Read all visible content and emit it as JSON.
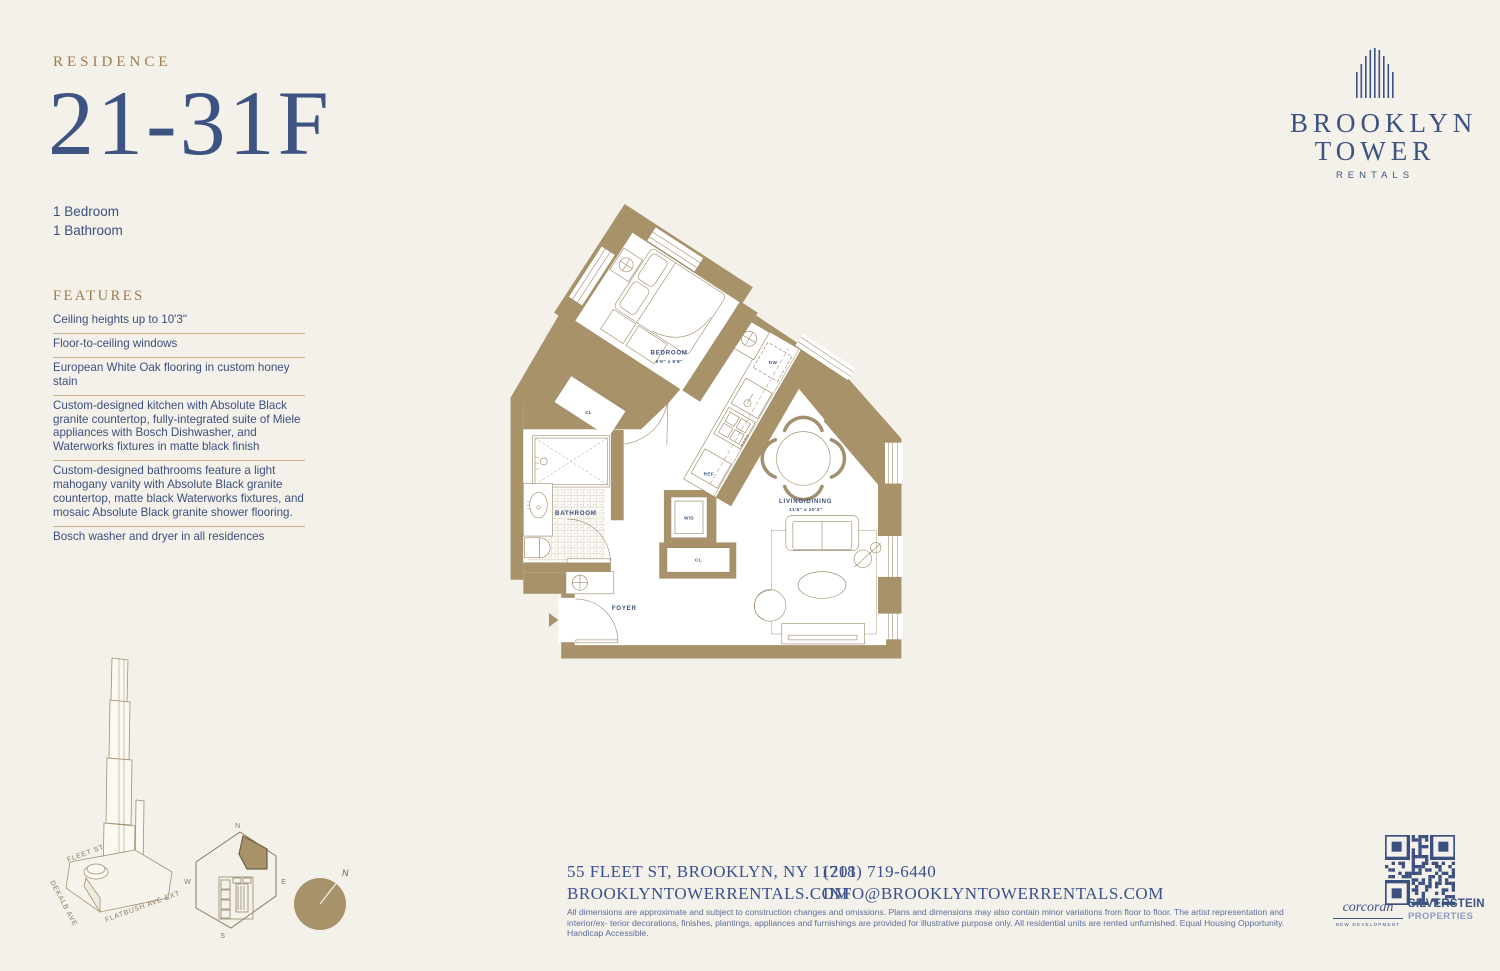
{
  "colors": {
    "accent_blue": "#3d5382",
    "gold": "#9b7b4e",
    "tan": "#a8926a",
    "bg": "#f4f1ea"
  },
  "header": {
    "residence_label": "RESIDENCE",
    "unit_number": "21-31F",
    "bedrooms": "1 Bedroom",
    "bathrooms": "1 Bathroom",
    "features_title": "FEATURES",
    "features": [
      "Ceiling heights up to 10'3\"",
      "Floor-to-ceiling windows",
      "European White Oak flooring in custom honey stain",
      "Custom-designed kitchen with Absolute Black granite countertop, fully-integrated suite of Miele appliances with Bosch Dishwasher, and Waterworks fixtures in matte black finish",
      "Custom-designed bathrooms feature a light mahogany vanity with Absolute Black granite countertop, matte black Waterworks fixtures, and mosaic Absolute Black granite shower flooring.",
      "Bosch washer and dryer in all residences"
    ]
  },
  "brand": {
    "line1": "BROOKLYN",
    "line2": "TOWER",
    "sub": "RENTALS"
  },
  "plan": {
    "bedroom_name": "BEDROOM",
    "bedroom_dims": "9'6\" x 9'8\"",
    "living_name": "LIVING/DINING",
    "living_dims": "11'6\" x 20'3\"",
    "bathroom_name": "BATHROOM",
    "foyer_name": "FOYER",
    "closet1": "CL",
    "closet2": "CL",
    "wd": "W/D",
    "ref": "REF",
    "dw": "DW"
  },
  "sitekey": {
    "n": "N",
    "e": "E",
    "s": "S",
    "w": "W"
  },
  "compass": {
    "n": "N"
  },
  "streets": {
    "fleet": "FLEET ST",
    "dekalb": "DEKALB AVE",
    "flatbush": "FLATBUSH AVE EXT"
  },
  "footer": {
    "address": "55 FLEET ST, BROOKLYN, NY 11201",
    "website": "BROOKLYNTOWERRENTALS.COM",
    "phone": "(718) 719-6440",
    "email": "INFO@BROOKLYNTOWERRENTALS.COM",
    "disclaimer_line1": "All dimensions are approximate and subject to construction changes and omissions. Plans and dimensions may also contain minor variations from floor to floor. The artist representation and interior/ex-",
    "disclaimer_line2": "terior decorations, finishes, plantings, appliances and furnishings are provided for illustrative purpose only. All residential units are rented unfurnished. Equal Housing Opportunity. Handicap Accessible.",
    "corcoran": "corcoran",
    "corcoran_sub": "NEW DEVELOPMENT",
    "silverstein": "SILVERSTEIN",
    "silverstein_sub": "PROPERTIES"
  }
}
